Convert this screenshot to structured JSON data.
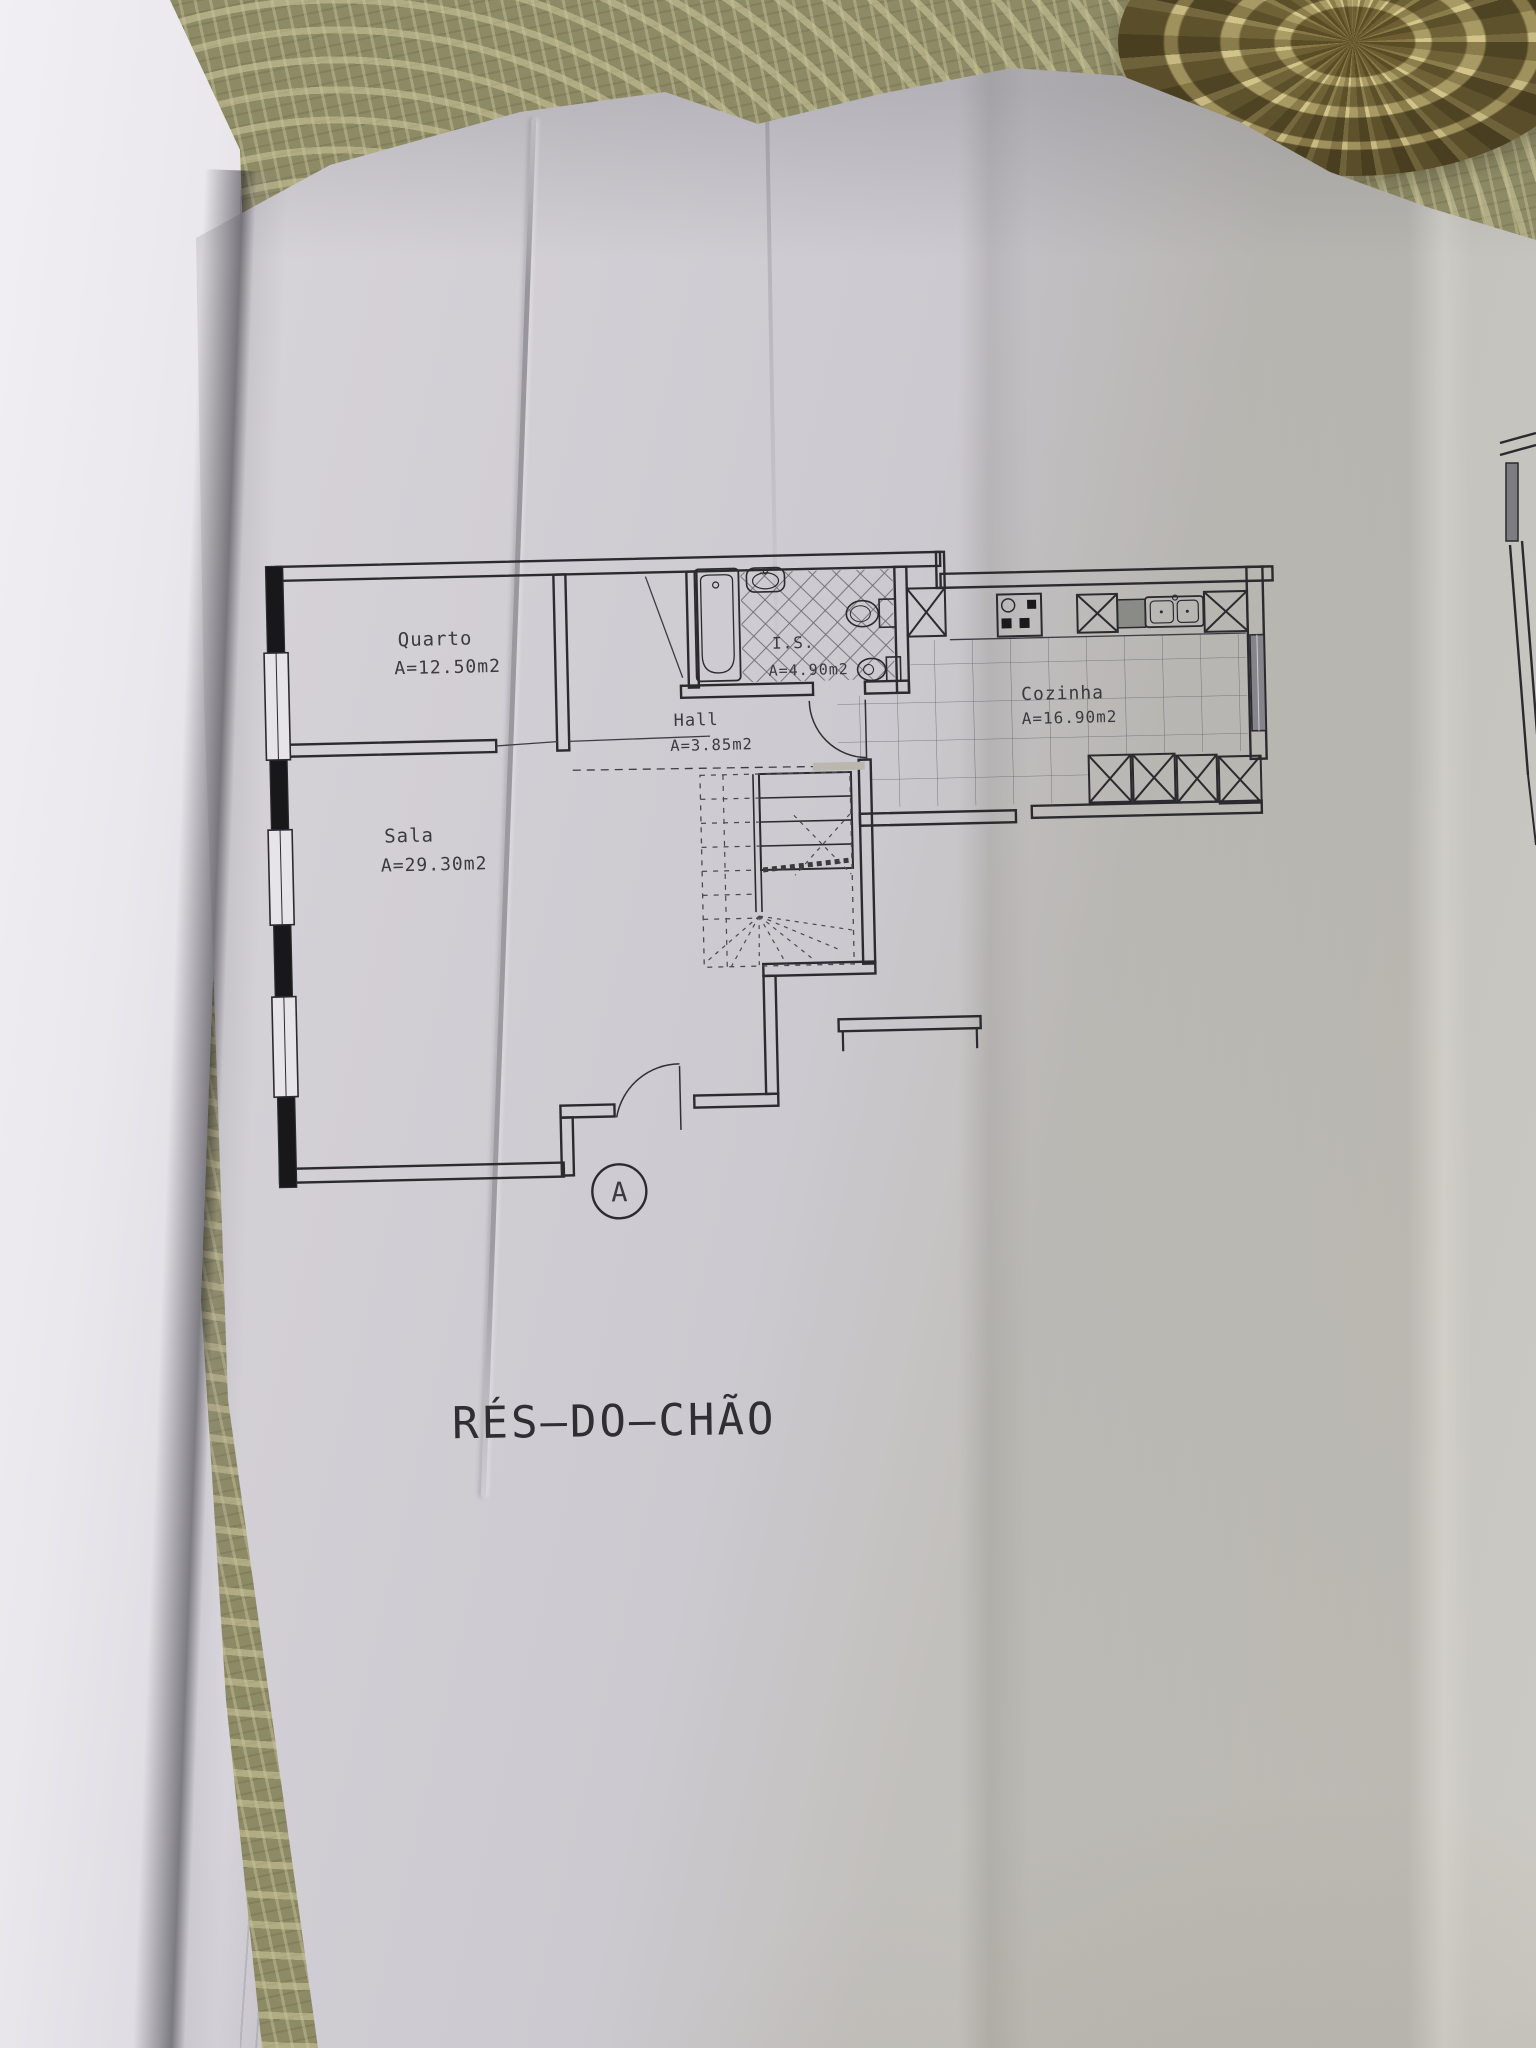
{
  "plan": {
    "title": "RÉS—DO—CHÃO",
    "section_marker": "A",
    "rooms": [
      {
        "name": "Quarto",
        "area": "A=12.50m2"
      },
      {
        "name": "Sala",
        "area": "A=29.30m2"
      },
      {
        "name": "Hall",
        "area": "A=3.85m2"
      },
      {
        "name": "I.S.",
        "area": "A=4.90m2"
      },
      {
        "name": "Cozinha",
        "area": "A=16.90m2"
      }
    ]
  },
  "colors": {
    "ink": "#2b2b2f",
    "paper": "#cfccd3",
    "left_pages": "#e9e7ec",
    "tablecloth": "#8d8a66",
    "doily": "#b3a87c"
  }
}
